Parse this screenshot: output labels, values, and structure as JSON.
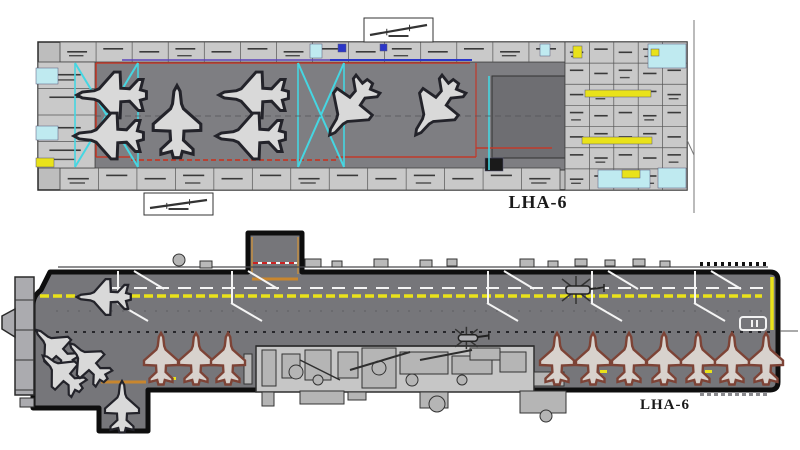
{
  "labels": {
    "hangar": "LHA-6",
    "deck": "LHA-6"
  },
  "colors": {
    "base": "#bdbdbd",
    "deck_gray": "#76767a",
    "hangar_gray": "#7e7e82",
    "hangar_dark": "#6e6e72",
    "room_gray": "#c9c9c9",
    "red": "#c03a2a",
    "cyan": "#45d6e2",
    "cyan_fill": "#bfeaf0",
    "yellow": "#e9e21a",
    "orange": "#c8862e",
    "tan": "#b08850",
    "blue": "#2b36c8",
    "white": "#f4f4f4",
    "island_gray": "#c6c6c6",
    "machine_gray": "#b5b5b5",
    "ac_fill": "#d9d9d9",
    "ac_stroke": "#23232a",
    "ac_brown": "#7d4336"
  },
  "hangar": {
    "outline": {
      "x": 38,
      "y": 42,
      "w": 649,
      "h": 148
    },
    "bay": {
      "x": 95,
      "y": 62,
      "w": 470,
      "h": 108
    },
    "bay_inner": {
      "x": 492,
      "y": 76,
      "w": 73,
      "h": 82
    },
    "bands": [
      {
        "x": 60,
        "y": 42,
        "w": 505,
        "h": 20,
        "cols": 14,
        "rows": 1
      },
      {
        "x": 60,
        "y": 168,
        "w": 500,
        "h": 22,
        "cols": 13,
        "rows": 1
      },
      {
        "x": 38,
        "y": 62,
        "w": 57,
        "h": 106,
        "cols": 1,
        "rows": 4
      },
      {
        "x": 565,
        "y": 42,
        "w": 122,
        "h": 148,
        "cols": 5,
        "rows": 7
      }
    ],
    "accents": [
      {
        "x": 36,
        "y": 68,
        "w": 22,
        "h": 16,
        "c": "cyan_fill"
      },
      {
        "x": 36,
        "y": 126,
        "w": 22,
        "h": 14,
        "c": "cyan_fill"
      },
      {
        "x": 36,
        "y": 158,
        "w": 18,
        "h": 9,
        "c": "yellow"
      },
      {
        "x": 648,
        "y": 44,
        "w": 38,
        "h": 24,
        "c": "cyan_fill"
      },
      {
        "x": 598,
        "y": 170,
        "w": 52,
        "h": 18,
        "c": "cyan_fill"
      },
      {
        "x": 658,
        "y": 168,
        "w": 28,
        "h": 20,
        "c": "cyan_fill"
      },
      {
        "x": 573,
        "y": 46,
        "w": 9,
        "h": 12,
        "c": "yellow"
      },
      {
        "x": 651,
        "y": 49,
        "w": 8,
        "h": 7,
        "c": "yellow"
      },
      {
        "x": 585,
        "y": 90,
        "w": 66,
        "h": 7,
        "c": "yellow"
      },
      {
        "x": 582,
        "y": 137,
        "w": 70,
        "h": 7,
        "c": "yellow"
      },
      {
        "x": 622,
        "y": 170,
        "w": 18,
        "h": 8,
        "c": "yellow"
      },
      {
        "x": 485,
        "y": 158,
        "w": 18,
        "h": 13,
        "c": "#1a1a1a"
      },
      {
        "x": 310,
        "y": 44,
        "w": 12,
        "h": 14,
        "c": "cyan_fill"
      },
      {
        "x": 338,
        "y": 44,
        "w": 8,
        "h": 8,
        "c": "blue"
      },
      {
        "x": 380,
        "y": 44,
        "w": 7,
        "h": 7,
        "c": "blue"
      },
      {
        "x": 540,
        "y": 44,
        "w": 10,
        "h": 12,
        "c": "cyan_fill"
      }
    ],
    "lines": [
      {
        "x1": 96,
        "y1": 63,
        "x2": 470,
        "y2": 63,
        "c": "red",
        "w": 1.6
      },
      {
        "x1": 96,
        "y1": 63,
        "x2": 96,
        "y2": 157,
        "c": "red",
        "w": 1.6
      },
      {
        "x1": 96,
        "y1": 157,
        "x2": 130,
        "y2": 157,
        "c": "red",
        "w": 1.6
      },
      {
        "x1": 131,
        "y1": 160,
        "x2": 336,
        "y2": 160,
        "c": "red",
        "w": 1.8,
        "dash": "5,3"
      },
      {
        "x1": 336,
        "y1": 157,
        "x2": 476,
        "y2": 157,
        "c": "red",
        "w": 1.6
      },
      {
        "x1": 476,
        "y1": 63,
        "x2": 476,
        "y2": 157,
        "c": "red",
        "w": 1.2
      },
      {
        "x1": 476,
        "y1": 148,
        "x2": 552,
        "y2": 148,
        "c": "red",
        "w": 1.4
      },
      {
        "x1": 330,
        "y1": 60,
        "x2": 472,
        "y2": 60,
        "c": "blue",
        "w": 2
      },
      {
        "x1": 122,
        "y1": 60,
        "x2": 330,
        "y2": 60,
        "c": "#5a43b8",
        "w": 1.4
      },
      {
        "x1": 75,
        "y1": 63,
        "x2": 138,
        "y2": 167,
        "c": "cyan",
        "w": 2
      },
      {
        "x1": 138,
        "y1": 63,
        "x2": 75,
        "y2": 167,
        "c": "cyan",
        "w": 2
      },
      {
        "x1": 75,
        "y1": 63,
        "x2": 75,
        "y2": 167,
        "c": "cyan",
        "w": 1.6
      },
      {
        "x1": 138,
        "y1": 63,
        "x2": 138,
        "y2": 167,
        "c": "cyan",
        "w": 1.6
      },
      {
        "x1": 298,
        "y1": 63,
        "x2": 344,
        "y2": 167,
        "c": "cyan",
        "w": 2
      },
      {
        "x1": 344,
        "y1": 63,
        "x2": 298,
        "y2": 167,
        "c": "cyan",
        "w": 2
      },
      {
        "x1": 298,
        "y1": 63,
        "x2": 298,
        "y2": 167,
        "c": "cyan",
        "w": 1.6
      },
      {
        "x1": 344,
        "y1": 63,
        "x2": 344,
        "y2": 167,
        "c": "cyan",
        "w": 1.6
      },
      {
        "x1": 489,
        "y1": 76,
        "x2": 489,
        "y2": 170,
        "c": "cyan",
        "w": 1.6
      },
      {
        "x1": 694,
        "y1": 20,
        "x2": 694,
        "y2": 213,
        "c": "#777777",
        "w": 1
      },
      {
        "x1": 687,
        "y1": 140,
        "x2": 694,
        "y2": 155,
        "c": "#777777",
        "w": 1
      },
      {
        "x1": 95,
        "y1": 116,
        "x2": 565,
        "y2": 116,
        "c": "#55555a",
        "w": 0.8,
        "dash": "6,4"
      }
    ],
    "elevator_boxes": [
      {
        "x": 364,
        "y": 18,
        "w": 69,
        "h": 24
      },
      {
        "x": 144,
        "y": 193,
        "w": 69,
        "h": 22
      }
    ],
    "aircraft": [
      {
        "x": 112,
        "y": 95,
        "r": -90,
        "s": 1.35
      },
      {
        "x": 109,
        "y": 136,
        "r": -90,
        "s": 1.35
      },
      {
        "x": 177,
        "y": 122,
        "r": 0,
        "s": 1.4
      },
      {
        "x": 254,
        "y": 95,
        "r": -90,
        "s": 1.35
      },
      {
        "x": 251,
        "y": 136,
        "r": -90,
        "s": 1.35
      },
      {
        "x": 350,
        "y": 108,
        "r": 217,
        "s": 1.3
      },
      {
        "x": 436,
        "y": 108,
        "r": 217,
        "s": 1.3
      }
    ]
  },
  "deck": {
    "hull_path": "M50,272 H248 V233 H302 V272 H770 Q778,272 778,280 V382 Q778,390 770,390 H148 V431 H99 V408 H33 V305 Q33,296 41,290 Z",
    "elevator_lines": [
      {
        "x1": 252,
        "y1": 279,
        "x2": 298,
        "y2": 279,
        "c": "orange",
        "w": 3
      },
      {
        "x1": 252,
        "y1": 237,
        "x2": 252,
        "y2": 274,
        "c": "tan",
        "w": 2
      },
      {
        "x1": 298,
        "y1": 237,
        "x2": 298,
        "y2": 274,
        "c": "tan",
        "w": 2
      },
      {
        "x1": 253,
        "y1": 263,
        "x2": 297,
        "y2": 263,
        "c": "white",
        "w": 2
      },
      {
        "x1": 253,
        "y1": 263,
        "x2": 297,
        "y2": 263,
        "c": "#cc2222",
        "w": 2,
        "dash": "5,4"
      },
      {
        "x1": 101,
        "y1": 382,
        "x2": 146,
        "y2": 382,
        "c": "orange",
        "w": 3
      }
    ],
    "markings": [
      {
        "x1": 58,
        "y1": 267,
        "x2": 768,
        "y2": 267,
        "c": "#4a4a4e",
        "w": 1.2
      },
      {
        "x1": 700,
        "y1": 264,
        "x2": 768,
        "y2": 264,
        "c": "#111111",
        "w": 4,
        "dash": "3,4"
      },
      {
        "x1": 112,
        "y1": 288,
        "x2": 766,
        "y2": 288,
        "c": "white",
        "w": 2,
        "dash": "13,9"
      },
      {
        "x1": 40,
        "y1": 296,
        "x2": 762,
        "y2": 296,
        "c": "yellow",
        "w": 3.5,
        "dash": "9,4"
      },
      {
        "x1": 772,
        "y1": 277,
        "x2": 772,
        "y2": 330,
        "c": "yellow",
        "w": 3.5
      },
      {
        "x1": 56,
        "y1": 332,
        "x2": 770,
        "y2": 332,
        "c": "#26262a",
        "w": 2,
        "dash": "3,6"
      },
      {
        "x1": 56,
        "y1": 311,
        "x2": 770,
        "y2": 311,
        "c": "#5e5e62",
        "w": 1,
        "dash": "2,9"
      },
      {
        "x1": 780,
        "y1": 331,
        "x2": 798,
        "y2": 331,
        "c": "#555555",
        "w": 1
      },
      {
        "x1": 700,
        "y1": 394,
        "x2": 768,
        "y2": 394,
        "c": "#8a8a8e",
        "w": 4,
        "dash": "4,3"
      }
    ],
    "stations": [
      118,
      232,
      488,
      592,
      695
    ],
    "bow": {
      "column": {
        "x": 15,
        "y": 277,
        "w": 19,
        "h": 118
      },
      "dividers": [
        300,
        330,
        360,
        390
      ],
      "point": "2,316 15,309 15,337 2,329",
      "foot": {
        "x": 20,
        "y": 398,
        "w": 14,
        "h": 9
      }
    },
    "top_furniture": [
      {
        "x": 200,
        "y": 261,
        "w": 12,
        "h": 7
      },
      {
        "x": 305,
        "y": 259,
        "w": 16,
        "h": 8
      },
      {
        "x": 332,
        "y": 261,
        "w": 10,
        "h": 6
      },
      {
        "x": 374,
        "y": 259,
        "w": 14,
        "h": 8
      },
      {
        "x": 420,
        "y": 260,
        "w": 12,
        "h": 7
      },
      {
        "x": 447,
        "y": 259,
        "w": 10,
        "h": 7
      },
      {
        "x": 520,
        "y": 259,
        "w": 14,
        "h": 8
      },
      {
        "x": 548,
        "y": 261,
        "w": 10,
        "h": 6
      },
      {
        "x": 575,
        "y": 259,
        "w": 12,
        "h": 7
      },
      {
        "x": 605,
        "y": 260,
        "w": 10,
        "h": 6
      },
      {
        "x": 633,
        "y": 259,
        "w": 12,
        "h": 7
      },
      {
        "x": 660,
        "y": 261,
        "w": 10,
        "h": 6
      }
    ],
    "island": {
      "base": {
        "x": 256,
        "y": 346,
        "w": 278,
        "h": 46
      },
      "rects": [
        {
          "x": 244,
          "y": 354,
          "w": 8,
          "h": 30
        },
        {
          "x": 262,
          "y": 350,
          "w": 14,
          "h": 36
        },
        {
          "x": 282,
          "y": 354,
          "w": 18,
          "h": 24
        },
        {
          "x": 305,
          "y": 350,
          "w": 26,
          "h": 30
        },
        {
          "x": 338,
          "y": 352,
          "w": 20,
          "h": 26
        },
        {
          "x": 362,
          "y": 348,
          "w": 34,
          "h": 40
        },
        {
          "x": 400,
          "y": 352,
          "w": 48,
          "h": 22
        },
        {
          "x": 452,
          "y": 356,
          "w": 40,
          "h": 18
        },
        {
          "x": 470,
          "y": 348,
          "w": 30,
          "h": 12
        },
        {
          "x": 500,
          "y": 352,
          "w": 26,
          "h": 20
        },
        {
          "x": 534,
          "y": 372,
          "w": 30,
          "h": 14
        },
        {
          "x": 262,
          "y": 392,
          "w": 12,
          "h": 14
        },
        {
          "x": 348,
          "y": 392,
          "w": 18,
          "h": 8
        },
        {
          "x": 300,
          "y": 391,
          "w": 44,
          "h": 13
        },
        {
          "x": 420,
          "y": 392,
          "w": 28,
          "h": 16
        },
        {
          "x": 520,
          "y": 391,
          "w": 46,
          "h": 22
        }
      ],
      "circles": [
        {
          "x": 379,
          "y": 368,
          "r": 7
        },
        {
          "x": 296,
          "y": 372,
          "r": 7
        },
        {
          "x": 318,
          "y": 380,
          "r": 5
        },
        {
          "x": 412,
          "y": 380,
          "r": 6
        },
        {
          "x": 462,
          "y": 380,
          "r": 5
        },
        {
          "x": 437,
          "y": 404,
          "r": 8
        },
        {
          "x": 179,
          "y": 260,
          "r": 6
        },
        {
          "x": 546,
          "y": 416,
          "r": 6
        }
      ],
      "lines": [
        {
          "x1": 350,
          "y1": 370,
          "x2": 410,
          "y2": 352,
          "w": 2
        },
        {
          "x1": 420,
          "y1": 360,
          "x2": 472,
          "y2": 350,
          "w": 2
        },
        {
          "x1": 300,
          "y1": 360,
          "x2": 340,
          "y2": 380,
          "w": 1.5
        },
        {
          "x1": 256,
          "y1": 346,
          "x2": 534,
          "y2": 346,
          "w": 1.5
        }
      ]
    },
    "helicopters": [
      {
        "x": 578,
        "y": 290,
        "s": 1.0
      },
      {
        "x": 468,
        "y": 338,
        "s": 0.8
      }
    ],
    "tractor": {
      "x": 740,
      "y": 317,
      "w": 26,
      "h": 13
    },
    "accent_ticks": [
      {
        "x": 168,
        "y": 377,
        "w": 8,
        "h": 3
      },
      {
        "x": 600,
        "y": 370,
        "w": 7,
        "h": 3
      },
      {
        "x": 705,
        "y": 370,
        "w": 7,
        "h": 3
      }
    ],
    "aircraft_dark": [
      {
        "x": 104,
        "y": 297,
        "r": -90,
        "s": 1.05
      },
      {
        "x": 55,
        "y": 348,
        "r": -46,
        "s": 1.0
      },
      {
        "x": 62,
        "y": 373,
        "r": -48,
        "s": 1.0
      },
      {
        "x": 88,
        "y": 362,
        "r": -44,
        "s": 1.0
      },
      {
        "x": 122,
        "y": 407,
        "r": 0,
        "s": 1.0
      }
    ],
    "aircraft_brown": [
      {
        "x": 161,
        "y": 359,
        "r": 0,
        "s": 1.0
      },
      {
        "x": 196,
        "y": 359,
        "r": 0,
        "s": 1.0
      },
      {
        "x": 228,
        "y": 359,
        "r": 0,
        "s": 1.0
      },
      {
        "x": 557,
        "y": 359,
        "r": 0,
        "s": 1.0
      },
      {
        "x": 593,
        "y": 359,
        "r": 0,
        "s": 1.0
      },
      {
        "x": 629,
        "y": 359,
        "r": 0,
        "s": 1.0
      },
      {
        "x": 664,
        "y": 359,
        "r": 0,
        "s": 1.0
      },
      {
        "x": 698,
        "y": 359,
        "r": 0,
        "s": 1.0
      },
      {
        "x": 732,
        "y": 359,
        "r": 0,
        "s": 1.0
      },
      {
        "x": 766,
        "y": 359,
        "r": 0,
        "s": 1.0
      }
    ]
  }
}
